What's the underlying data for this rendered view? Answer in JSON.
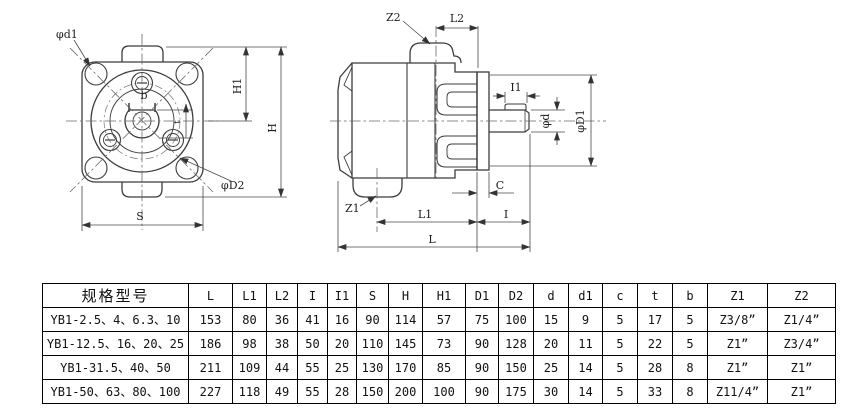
{
  "front_view": {
    "labels": {
      "phi_d1": "φd1",
      "b": "b",
      "t": "t",
      "h1": "H1",
      "h": "H",
      "phi_d2": "φD2",
      "s": "S"
    }
  },
  "side_view": {
    "labels": {
      "z2": "Z2",
      "l2": "L2",
      "i1": "I1",
      "phi_d": "φd",
      "phi_d1": "φD1",
      "c": "C",
      "z1": "Z1",
      "l1": "L1",
      "i": "I",
      "l": "L"
    }
  },
  "table": {
    "headers": [
      "规格型号",
      "L",
      "L1",
      "L2",
      "I",
      "I1",
      "S",
      "H",
      "H1",
      "D1",
      "D2",
      "d",
      "d1",
      "c",
      "t",
      "b",
      "Z1",
      "Z2"
    ],
    "rows": [
      [
        "YB1-2.5、4、6.3、10",
        "153",
        "80",
        "36",
        "41",
        "16",
        "90",
        "114",
        "57",
        "75",
        "100",
        "15",
        "9",
        "5",
        "17",
        "5",
        "Z3/8”",
        "Z1/4”"
      ],
      [
        "YB1-12.5、16、20、25",
        "186",
        "98",
        "38",
        "50",
        "20",
        "110",
        "145",
        "73",
        "90",
        "128",
        "20",
        "11",
        "5",
        "22",
        "5",
        "Z1”",
        "Z3/4”"
      ],
      [
        "YB1-31.5、40、50",
        "211",
        "109",
        "44",
        "55",
        "25",
        "130",
        "170",
        "85",
        "90",
        "150",
        "25",
        "14",
        "5",
        "28",
        "8",
        "Z1”",
        "Z1”"
      ],
      [
        "YB1-50、63、80、100",
        "227",
        "118",
        "49",
        "55",
        "28",
        "150",
        "200",
        "100",
        "90",
        "175",
        "30",
        "14",
        "5",
        "33",
        "8",
        "Z11/4”",
        "Z1”"
      ]
    ]
  },
  "colors": {
    "outline": "#3c3c3c",
    "thin_line": "#4a4a4a",
    "centerline": "#6a6a6a",
    "table_border": "#000000",
    "background": "#ffffff"
  }
}
